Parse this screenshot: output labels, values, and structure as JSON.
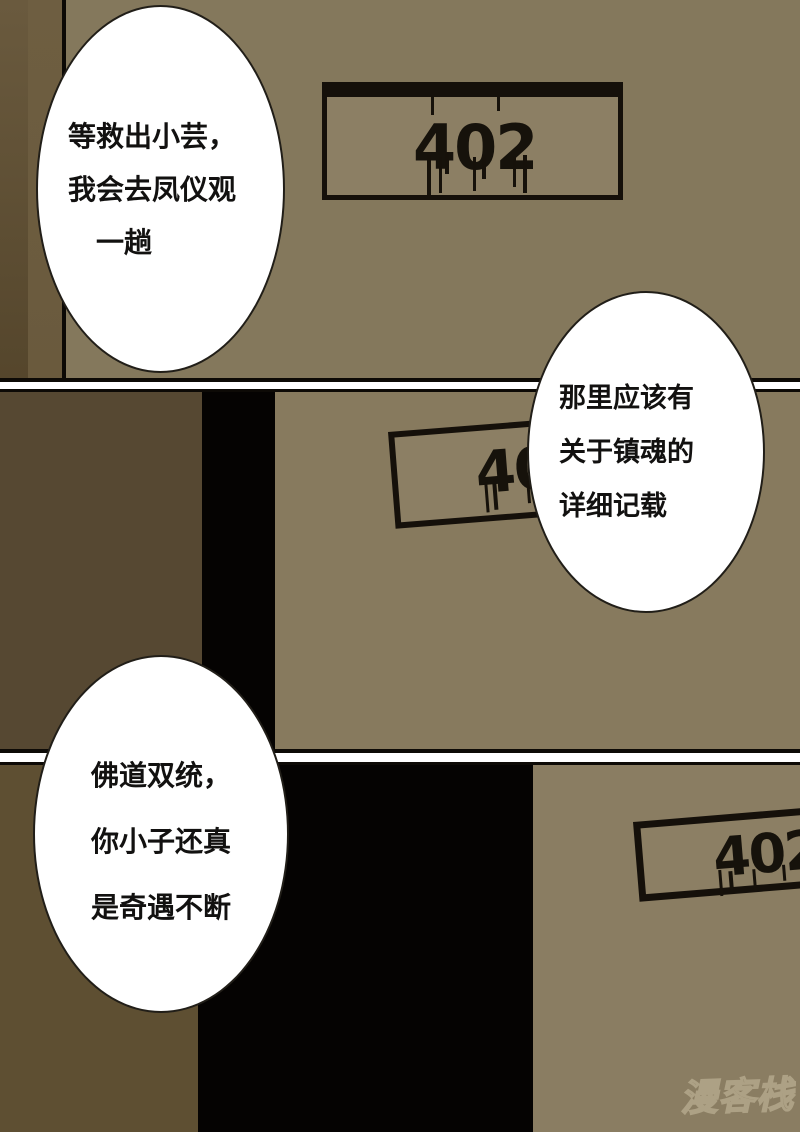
{
  "comic": {
    "type": "manhua-page",
    "panel_count": 3,
    "bubbles": [
      {
        "lines": [
          "等救出小芸，",
          "我会去凤仪观",
          "　一趟"
        ]
      },
      {
        "lines": [
          "那里应该有",
          "关于镇魂的",
          "详细记载"
        ]
      },
      {
        "lines": [
          "佛道双统，",
          "你小子还真",
          "是奇遇不断"
        ]
      }
    ],
    "signs": [
      {
        "number": "402"
      },
      {
        "number": "402"
      },
      {
        "number": "402"
      }
    ],
    "watermark": {
      "text": "漫客栈"
    },
    "colors": {
      "panel1_bg": "#84785c",
      "panel1_door_dark": "#5f5034",
      "panel1_door_mid": "#6a5a3d",
      "panel2_left_dark": "#564832",
      "panel2_bg": "#877a5e",
      "panel3_left_dark": "#5e4f32",
      "panel3_bg": "#8a7d62",
      "doorway_black": "#050302",
      "sign_face": "#8c7f64",
      "sign_border": "#15100a",
      "gutter": "#ffffff",
      "bubble_fill": "#ffffff",
      "bubble_outline": "#211e18",
      "text": "#121110",
      "watermark_stroke": "#b4a88c"
    }
  }
}
